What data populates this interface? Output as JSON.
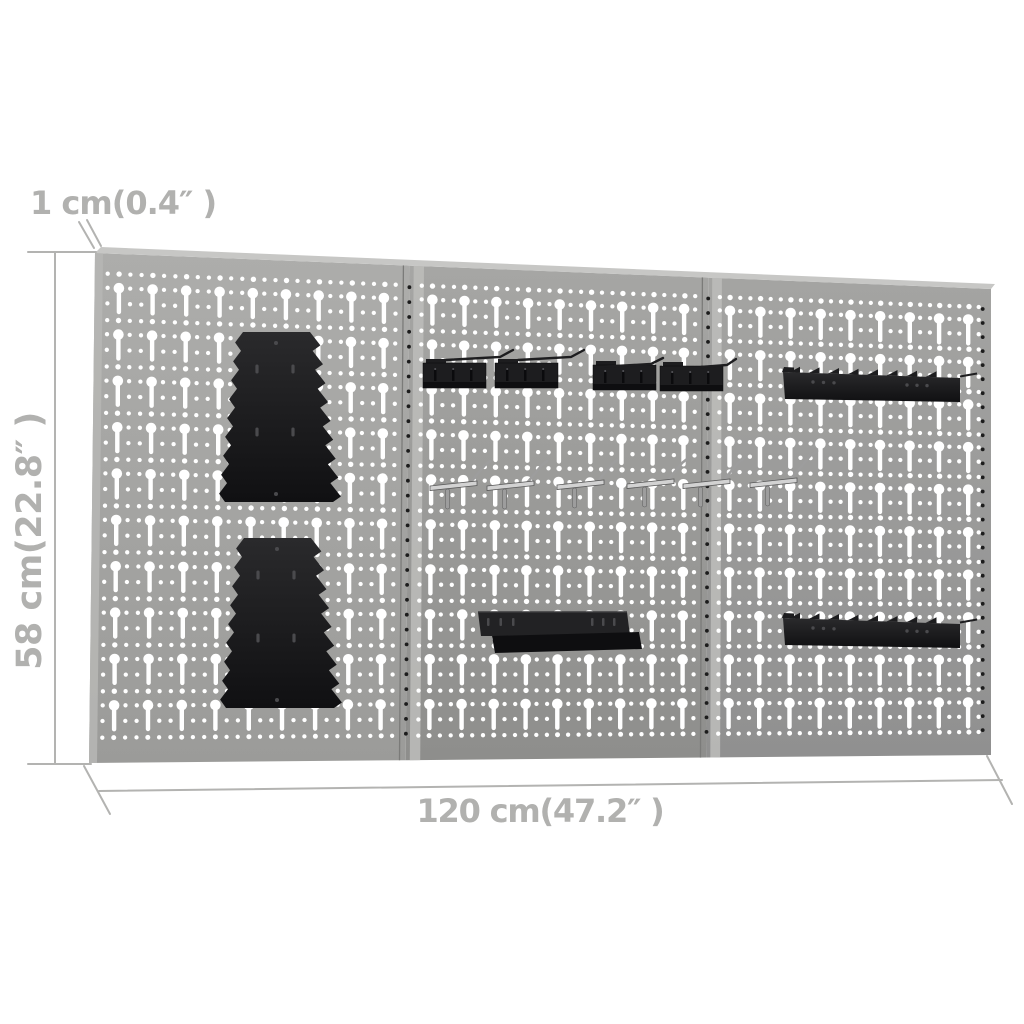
{
  "page": {
    "background_color": "#ffffff"
  },
  "labels": {
    "thickness": "1 cm(0.4″ )",
    "height": "58 cm(22.8″ )",
    "width": "120 cm(47.2″ )"
  },
  "colors": {
    "dimension_lines": "#b3b3b1",
    "dimension_text": "#b1b1af",
    "hole": "#ffffff",
    "edge_hole": "#1c1c1c",
    "top_edge": "#c7c7c5",
    "left_flange": "#b6b6b4",
    "divider_seam": "#7b7b79",
    "divider_strip": "#bdbdbb",
    "accessory_black": "#1d1d1f",
    "accessory_black_dark": "#0e0e10",
    "accessory_slot": "#4a4a4d",
    "chrome_light": "#d2d2d2",
    "chrome_mid": "#9d9d9d",
    "chrome_dark": "#5a5a5a",
    "panels": [
      {
        "top": "#adadab",
        "bottom": "#9b9b99"
      },
      {
        "top": "#a6a6a4",
        "bottom": "#8e8e8c"
      },
      {
        "top": "#a4a4a2",
        "bottom": "#909090"
      }
    ]
  },
  "board": {
    "panel_count": 3,
    "accessories": [
      {
        "type": "wrench-holder",
        "count": 2
      },
      {
        "type": "spring-clip-bracket",
        "count": 4
      },
      {
        "type": "tool-hook",
        "count": 6
      },
      {
        "type": "storage-shelf",
        "count": 1
      },
      {
        "type": "serrated-tool-rail",
        "count": 2
      }
    ]
  }
}
